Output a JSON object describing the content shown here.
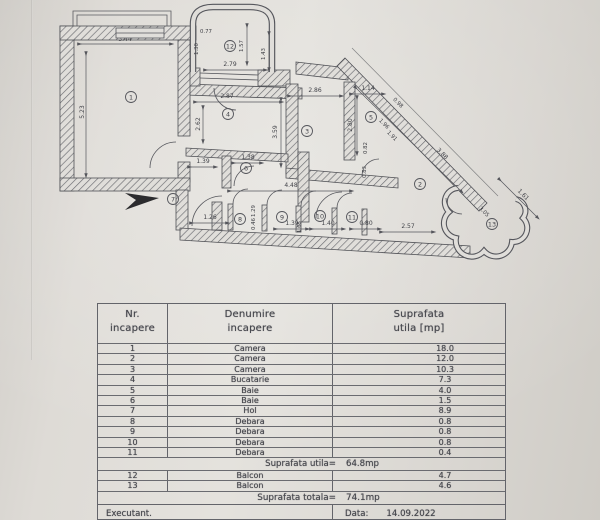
{
  "plan": {
    "rooms": {
      "r1": "1",
      "r2": "2",
      "r3": "3",
      "r4": "4",
      "r5": "5",
      "r6": "6",
      "r7": "7",
      "r8": "8",
      "r9": "9",
      "r10": "10",
      "r11": "11",
      "r12": "12",
      "r13": "13"
    },
    "dims": {
      "d344": "3.44",
      "d523": "5.23",
      "d077": "0.77",
      "d130": "1.30",
      "d157": "1.57",
      "d143": "1.43",
      "d279": "2.79",
      "d287": "2.87",
      "d262": "2.62",
      "d359": "3.59",
      "d286": "2.86",
      "d114": "1.14",
      "d280": "2.80",
      "d098": "0.98",
      "d196": "1.96",
      "d191": "1.91",
      "d388": "3.88",
      "d082": "0.82",
      "d083": "0.83",
      "d139a": "1.39",
      "d138": "1.38",
      "d448": "4.48",
      "d126": "1.26",
      "d165": "1.65",
      "d129": "1.29",
      "d046": "0.46",
      "d139b": "1.39",
      "d140": "1.40",
      "d080": "0.80",
      "d257": "2.57",
      "d161": "1.61",
      "d305": "3.05"
    }
  },
  "table": {
    "header": {
      "col1_line1": "Nr.",
      "col1_line2": "incapere",
      "col2_line1": "Denumire",
      "col2_line2": "incapere",
      "col3_line1": "Suprafata",
      "col3_line2": "utila [mp]"
    },
    "rows": [
      {
        "nr": "1",
        "name": "Camera",
        "area": "18.0"
      },
      {
        "nr": "2",
        "name": "Camera",
        "area": "12.0"
      },
      {
        "nr": "3",
        "name": "Camera",
        "area": "10.3"
      },
      {
        "nr": "4",
        "name": "Bucatarie",
        "area": "7.3"
      },
      {
        "nr": "5",
        "name": "Baie",
        "area": "4.0"
      },
      {
        "nr": "6",
        "name": "Baie",
        "area": "1.5"
      },
      {
        "nr": "7",
        "name": "Hol",
        "area": "8.9"
      },
      {
        "nr": "8",
        "name": "Debara",
        "area": "0.8"
      },
      {
        "nr": "9",
        "name": "Debara",
        "area": "0.8"
      },
      {
        "nr": "10",
        "name": "Debara",
        "area": "0.8"
      },
      {
        "nr": "11",
        "name": "Debara",
        "area": "0.4"
      }
    ],
    "subtotal": {
      "label": "Suprafata utila=",
      "value": "64.8mp"
    },
    "balcony_rows": [
      {
        "nr": "12",
        "name": "Balcon",
        "area": "4.7"
      },
      {
        "nr": "13",
        "name": "Balcon",
        "area": "4.6"
      }
    ],
    "total": {
      "label": "Suprafata totala=",
      "value": "74.1mp"
    },
    "footer": {
      "left": "Executant.",
      "date_label": "Data:",
      "date_value": "14.09.2022"
    }
  }
}
